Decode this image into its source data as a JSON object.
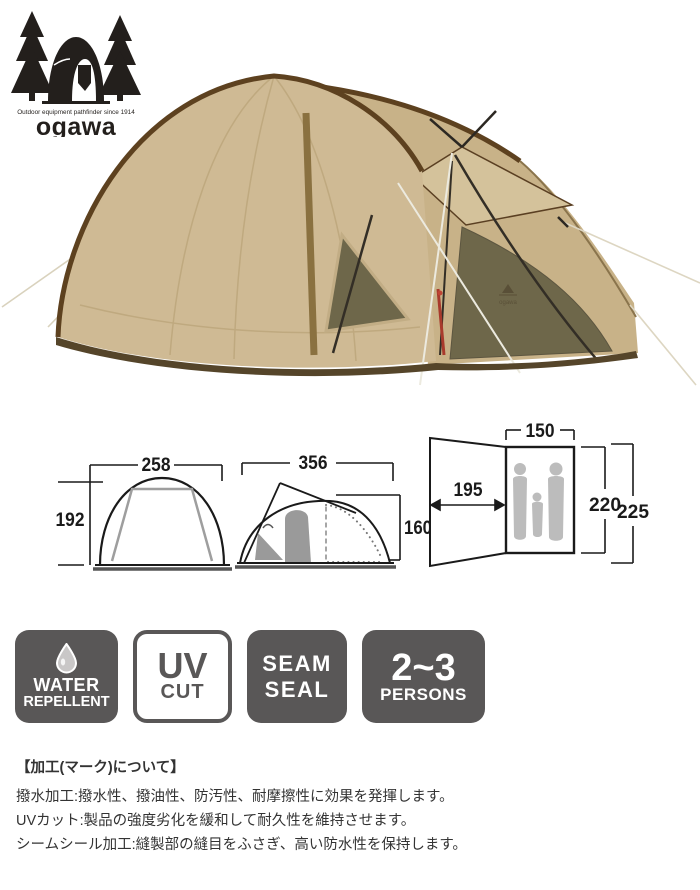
{
  "brand": {
    "tagline": "Outdoor equipment pathfinder since 1914",
    "logotype": "ogawa"
  },
  "photo": {
    "subject": "beige dome tent with brown trim and mesh entrance",
    "tent_logo_mark": "ogawa"
  },
  "diagrams": {
    "front_view": {
      "width": "258",
      "height": "192"
    },
    "side_view": {
      "width": "356",
      "height": "160"
    },
    "floor_plan": {
      "inner_width": "150",
      "vestibule_depth": "195",
      "inner_depth": "220",
      "total_depth": "225"
    }
  },
  "badges": [
    {
      "name": "water-repellent",
      "icon": "water-drop-icon",
      "line1": "WATER",
      "line2": "REPELLENT"
    },
    {
      "name": "uv-cut",
      "line1": "UV",
      "line2": "CUT"
    },
    {
      "name": "seam-seal",
      "line1": "SEAM",
      "line2": "SEAL"
    },
    {
      "name": "persons-2-3",
      "line1": "2~3",
      "line2": "PERSONS"
    }
  ],
  "notes": {
    "heading": "【加工(マーク)について】",
    "lines": [
      "撥水加工:撥水性、撥油性、防汚性、耐摩擦性に効果を発揮します。",
      "UVカット:製品の強度劣化を緩和して耐久性を維持させます。",
      "シームシール加工:縫製部の縫目をふさぎ、高い防水性を保持します。"
    ]
  },
  "colors": {
    "badge_dark": "#595757",
    "tent_beige": "#cfba94",
    "tent_trim": "#5d411f",
    "mesh_olive": "#6e674a",
    "diagram_line": "#1a1a1a",
    "diagram_gray": "#9e9e9e"
  }
}
